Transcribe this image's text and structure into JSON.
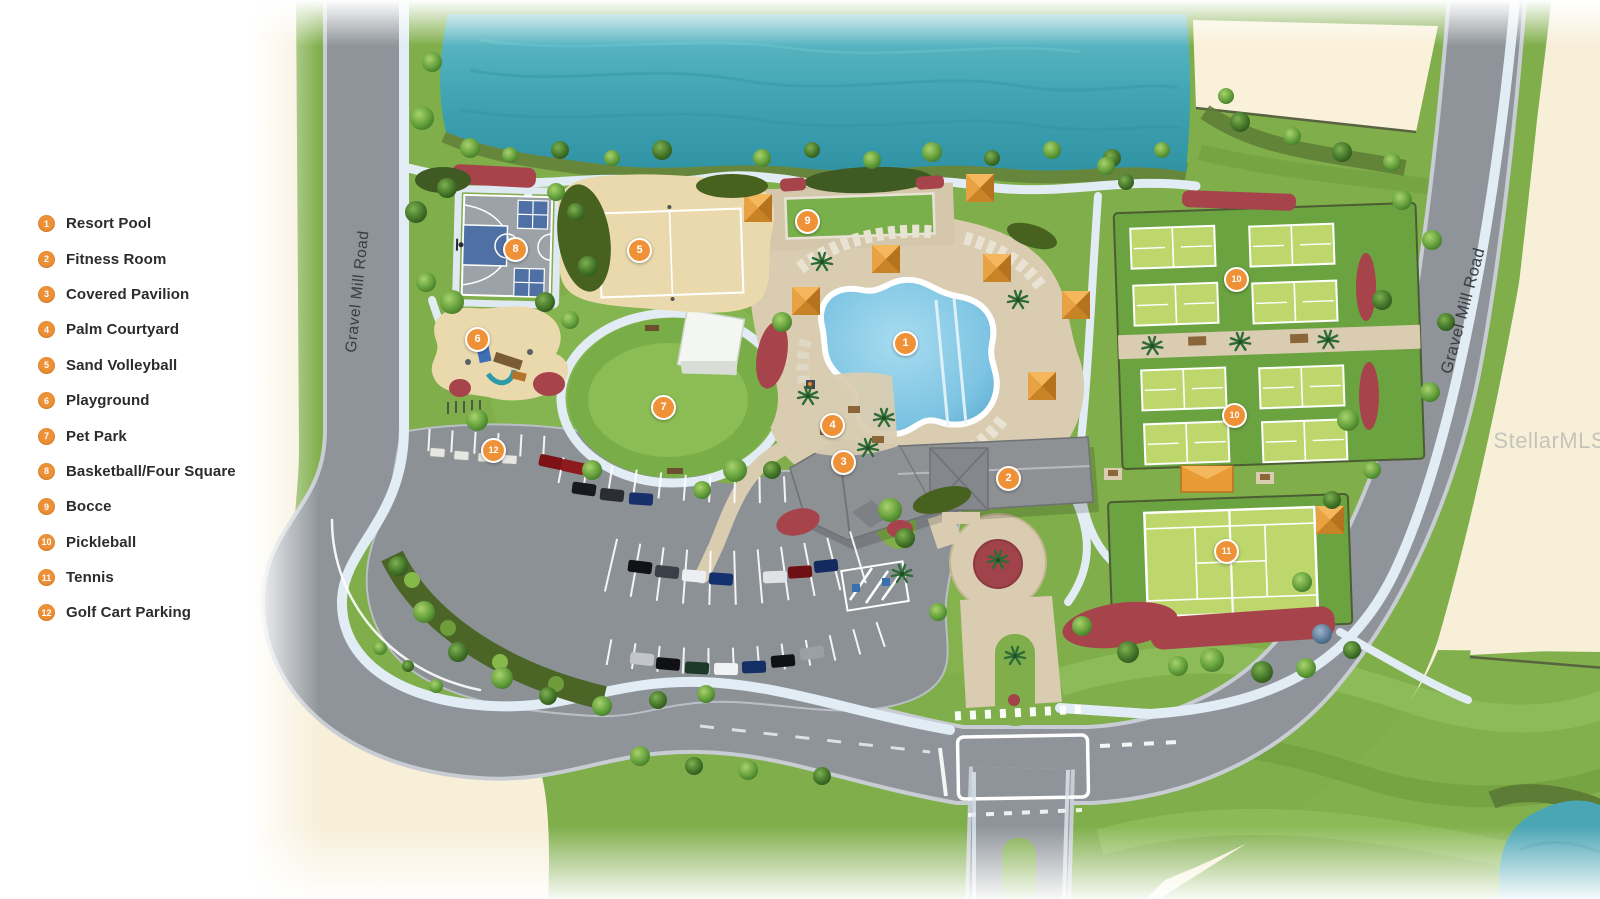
{
  "legend": {
    "items": [
      {
        "number": "1",
        "label": "Resort Pool"
      },
      {
        "number": "2",
        "label": "Fitness Room"
      },
      {
        "number": "3",
        "label": "Covered Pavilion"
      },
      {
        "number": "4",
        "label": "Palm Courtyard"
      },
      {
        "number": "5",
        "label": "Sand Volleyball"
      },
      {
        "number": "6",
        "label": "Playground"
      },
      {
        "number": "7",
        "label": "Pet Park"
      },
      {
        "number": "8",
        "label": "Basketball/Four Square"
      },
      {
        "number": "9",
        "label": "Bocce"
      },
      {
        "number": "10",
        "label": "Pickleball"
      },
      {
        "number": "11",
        "label": "Tennis"
      },
      {
        "number": "12",
        "label": "Golf Cart Parking"
      }
    ]
  },
  "map": {
    "road_label_left": "Gravel Mill Road",
    "road_label_right": "Gravel Mill Road",
    "watermark": "StellarMLS",
    "markers": [
      {
        "number": "1"
      },
      {
        "number": "2"
      },
      {
        "number": "3"
      },
      {
        "number": "4"
      },
      {
        "number": "5"
      },
      {
        "number": "6"
      },
      {
        "number": "7"
      },
      {
        "number": "8"
      },
      {
        "number": "9"
      },
      {
        "number": "10"
      },
      {
        "number": "10"
      },
      {
        "number": "11"
      },
      {
        "number": "12"
      }
    ]
  },
  "colors": {
    "marker_orange": "#ef9137",
    "site_green": "#7fae4a",
    "lake_teal": "#45a8b6",
    "pool_blue": "#8fd0ea",
    "road_gray": "#8e9499",
    "path_blue": "#e2ecf4",
    "sand_tan": "#ead9ac",
    "stone_tan": "#d9ccb1",
    "mulch_red": "#a6434b",
    "cream": "#f8efd9"
  }
}
